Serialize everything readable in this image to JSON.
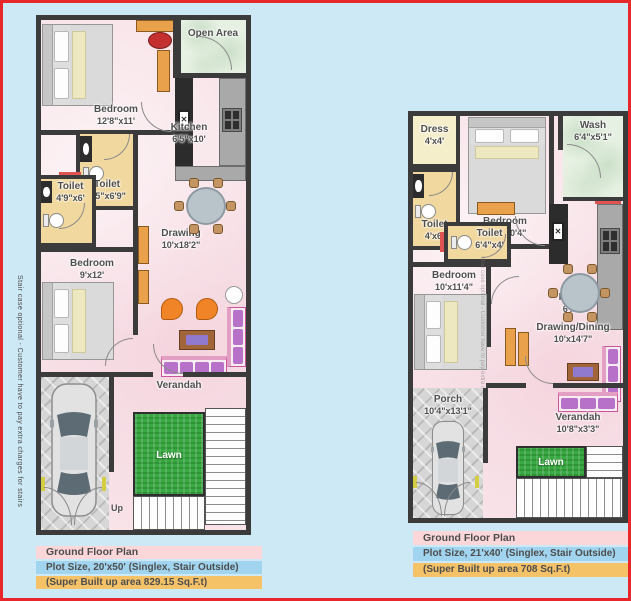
{
  "canvas": {
    "background": "#cde9f6",
    "frame_color": "#e8272b",
    "wall_color": "#3b3b3b",
    "floor_pink": "#f8e4e9",
    "toilet_tan": "#f1d89e",
    "lawn_green": "#3aa943",
    "footer_pink": "#fbd7da",
    "footer_blue": "#a0d4ef",
    "footer_orange": "#f6c268"
  },
  "side_note": "Stair case optional - Customer have to pay extra charges for stairs",
  "left_plan": {
    "rooms": {
      "open_area": {
        "name": "Open Area",
        "size": ""
      },
      "bedroom1": {
        "name": "Bedroom",
        "size": "12'8\"x11'"
      },
      "kitchen": {
        "name": "Kitchen",
        "size": "6'5\"x10'"
      },
      "toilet1": {
        "name": "Toilet",
        "size": "5'5\"x6'9\""
      },
      "toilet2": {
        "name": "Toilet",
        "size": "4'9\"x6'"
      },
      "drawing": {
        "name": "Drawing",
        "size": "10'x18'2\""
      },
      "bedroom2": {
        "name": "Bedroom",
        "size": "9'x12'"
      },
      "verandah": {
        "name": "Verandah",
        "size": ""
      },
      "lawn": {
        "name": "Lawn",
        "size": ""
      }
    },
    "up_label": "Up",
    "footer": {
      "title": "Ground Floor Plan",
      "plot": "Plot Size, 20'x50' (Singlex, Stair Outside)",
      "area": "(Super Built up area 829.15 Sq.F.t)"
    }
  },
  "right_plan": {
    "rooms": {
      "dress": {
        "name": "Dress",
        "size": "4'x4'"
      },
      "wash": {
        "name": "Wash",
        "size": "6'4\"x5'1\""
      },
      "bedroom1": {
        "name": "Bedroom",
        "size": "9'8\"x10'4\""
      },
      "toilet1": {
        "name": "Toilet",
        "size": "4'x6'"
      },
      "toilet2": {
        "name": "Toilet",
        "size": "6'4\"x4'"
      },
      "kitchen": {
        "name": "Kitchen",
        "size": "6'x9'2\""
      },
      "bedroom2": {
        "name": "Bedroom",
        "size": "10'x11'4\""
      },
      "drawing_dining": {
        "name": "Drawing/Dining",
        "size": "10'x14'7\""
      },
      "porch": {
        "name": "Porch",
        "size": "10'4\"x13'1\""
      },
      "verandah": {
        "name": "Verandah",
        "size": "10'8\"x3'3\""
      },
      "lawn": {
        "name": "Lawn",
        "size": ""
      }
    },
    "footer": {
      "title": "Ground Floor Plan",
      "plot": "Plot Size, 21'x40' (Singlex, Stair Outside)",
      "area": "(Super Built up area 708 Sq.F.t)"
    }
  }
}
